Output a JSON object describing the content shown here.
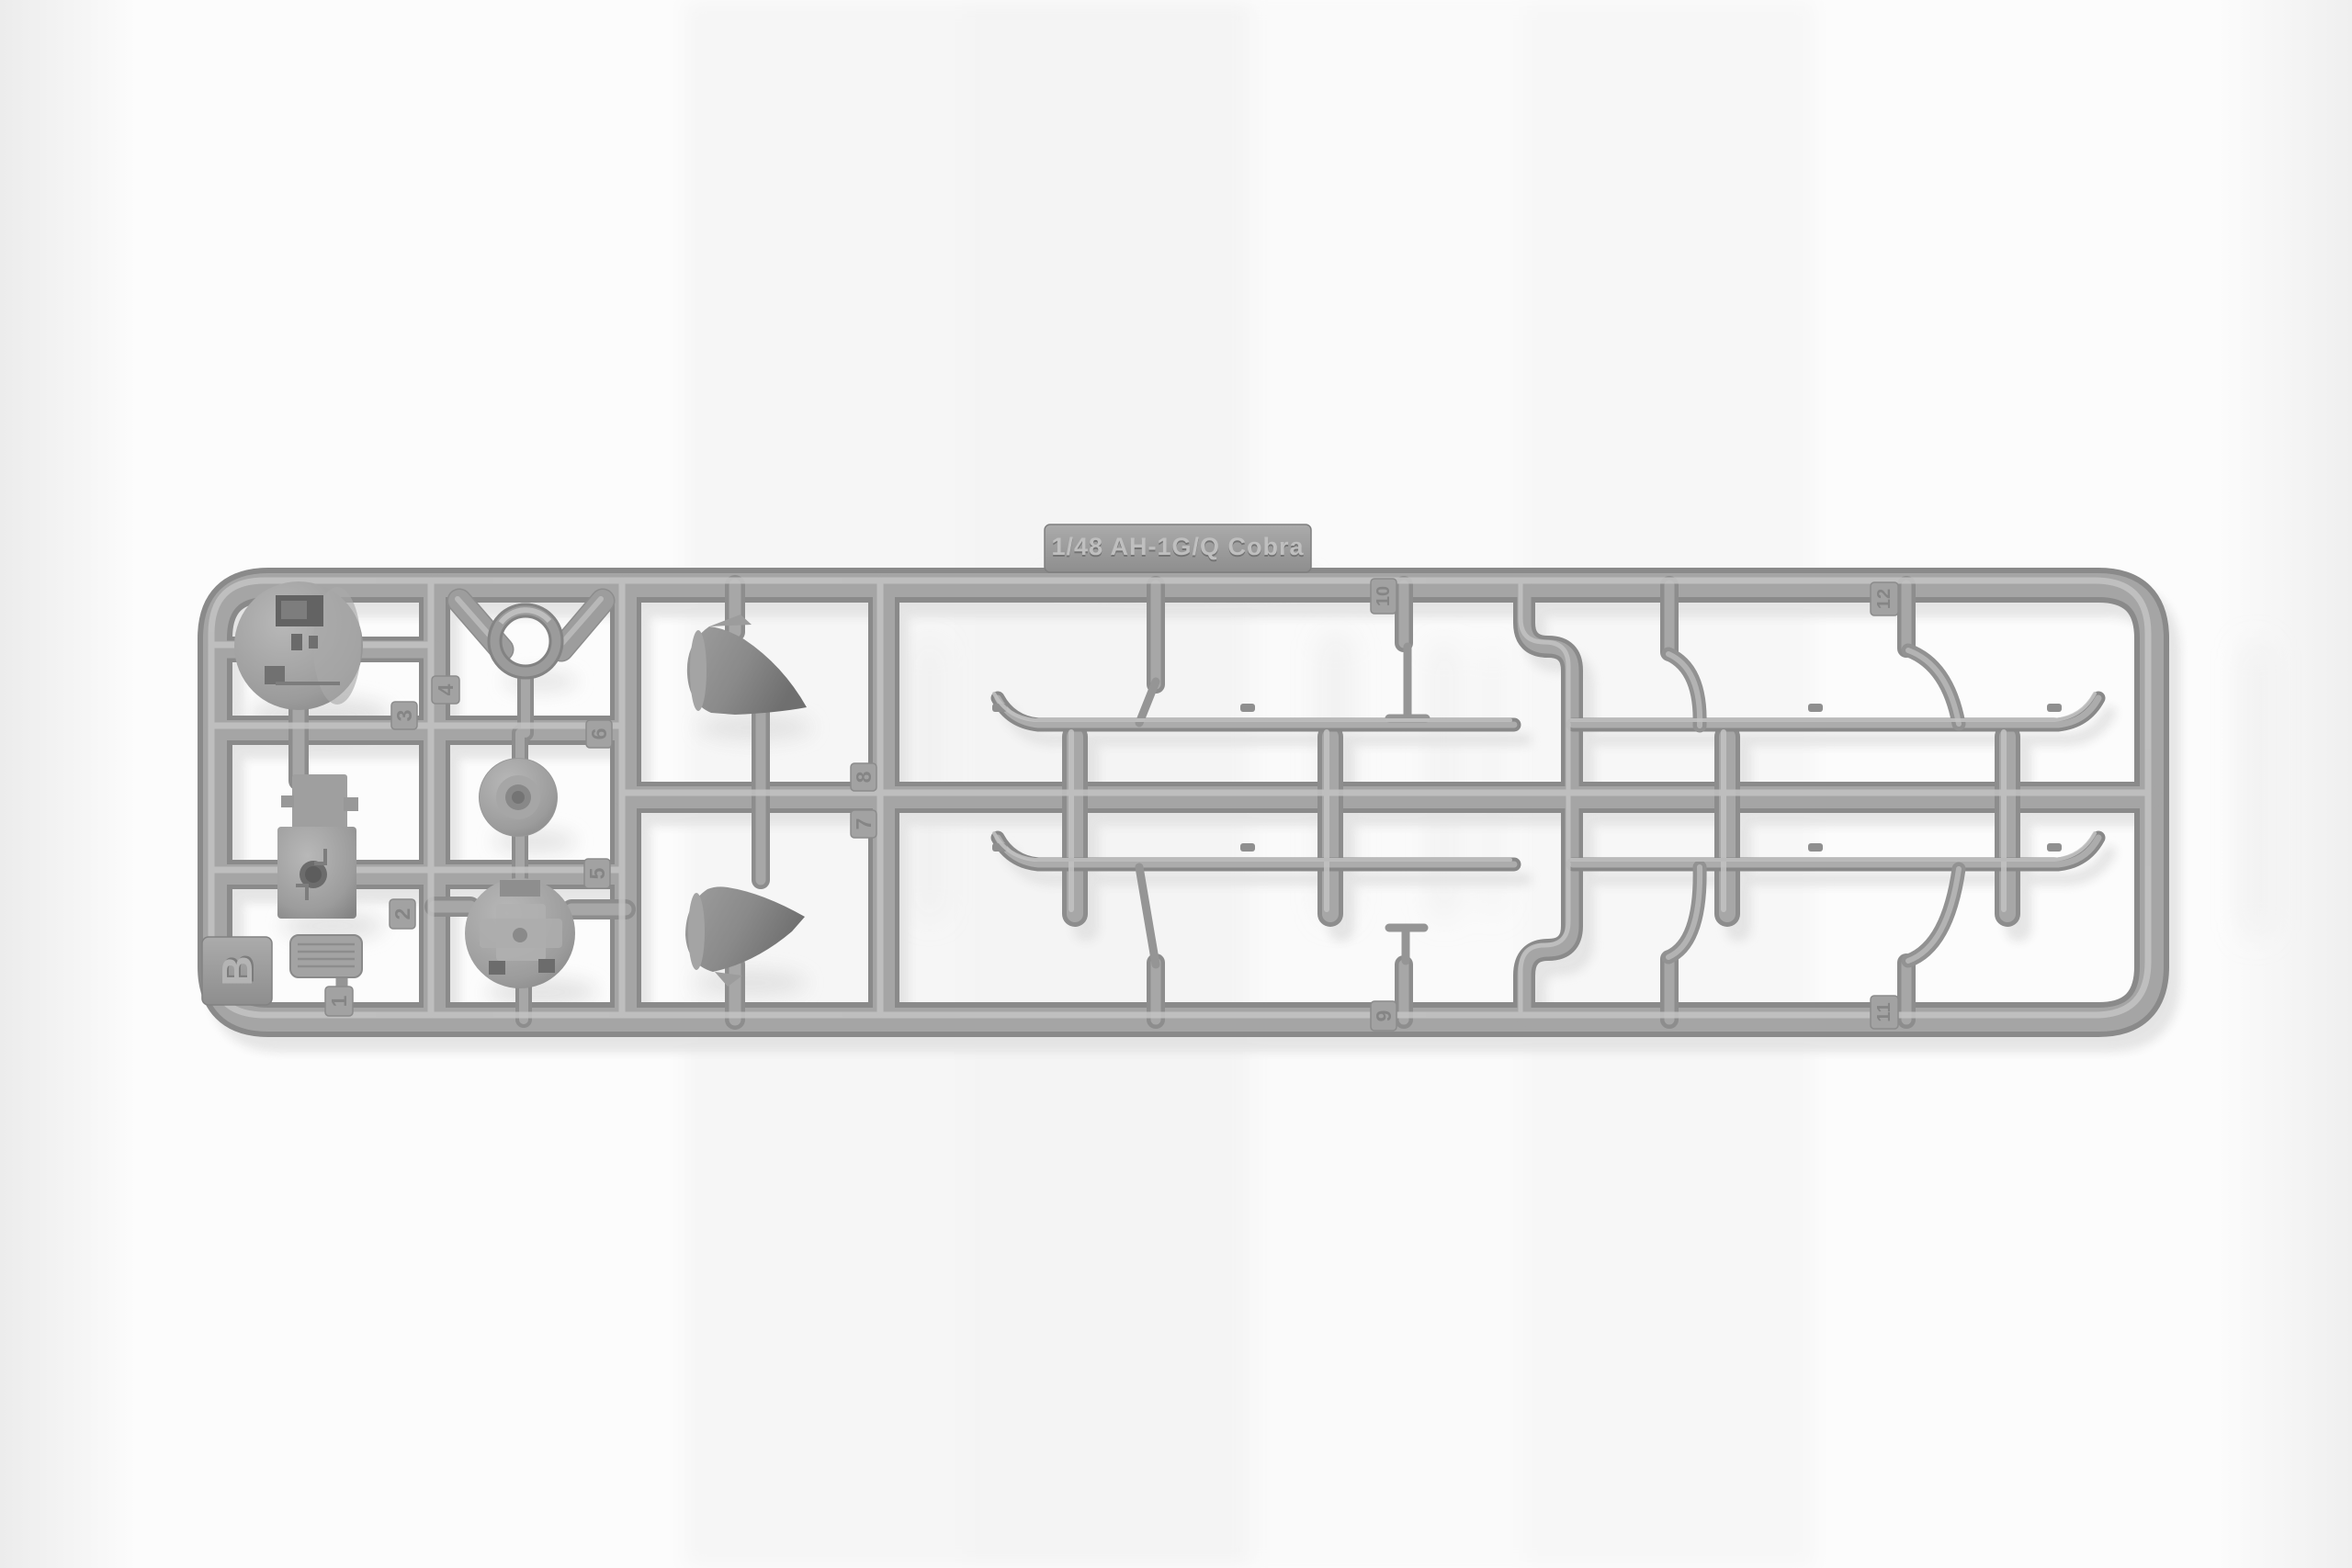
{
  "image": {
    "type": "photograph",
    "subject": "Gray polystyrene injection-molded sprue (runner B) from a 1/48 scale AH-1G/Q Cobra helicopter model kit, photographed on a white background; contains landing skids, gun-turret halves, exhaust cone parts and small detail parts",
    "background_color": "#fcfcfc"
  },
  "sprue": {
    "nameplate_text": "1/48 AH-1G/Q Cobra",
    "runner_letter": "B",
    "part_number_tags": [
      "1",
      "2",
      "3",
      "4",
      "5",
      "6",
      "7",
      "8",
      "9",
      "10",
      "11",
      "12"
    ],
    "colors": {
      "plastic_base": "#a5a5a5",
      "plastic_edge": "#8a8a8a",
      "plastic_highlight": "#c3c3c3",
      "cast_shadow": "#e2e2e2"
    }
  }
}
